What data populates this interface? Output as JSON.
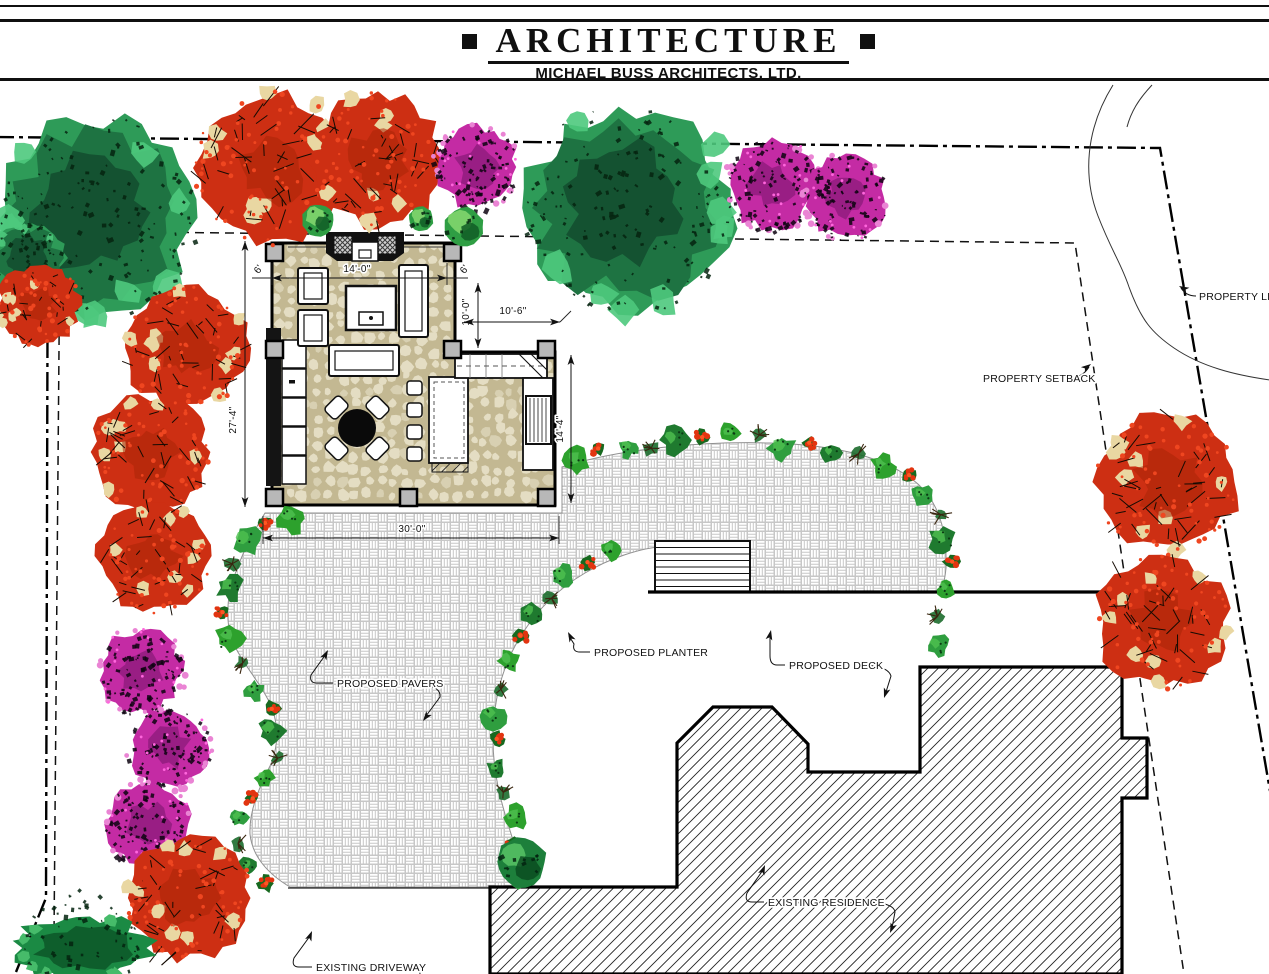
{
  "header": {
    "title": "ARCHITECTURE",
    "subtitle": "MICHAEL BUSS ARCHITECTS, LTD."
  },
  "plan": {
    "colors": {
      "paver_line": "#c7c7c7",
      "floor_bg": "#c3b892",
      "floor_stone": "#e4ddc3",
      "pier_fill": "#b8b8b8",
      "green_outer": "#2e9b58",
      "green_mid": "#1e7342",
      "green_core": "#145231",
      "green_light": "#4ec97d",
      "red_base": "#cd2f13",
      "red_dark": "#a92408",
      "red_dot": "#ef4620",
      "tan": "#e9d7a2",
      "magenta": "#c42ba4",
      "magenta_dark": "#7d1570",
      "magenta_light": "#ea84d4",
      "flower_red": "#e23410",
      "twig_brown": "#3a2610"
    },
    "boundary": {
      "property_line_path": "M-5,137 L1160,148 L1270,791 M48,141 L46,898 L16,972",
      "setback_path": "M60,231 L1075,243 L1184,974 M60,231 L54,935 L40,974",
      "walk_curve": "M1113,85 C1085,130 1083,177 1098,216 C1112,252 1121,263 1129,287 C1141,320 1152,333 1174,348 C1202,367 1235,375 1270,380",
      "walk_curve2": "M1152,85 C1138,100 1131,112 1127,127"
    },
    "annotations": [
      {
        "id": "property-line",
        "text": "PROPERTY LINE",
        "tx": 1199,
        "ty": 300,
        "leader": "M1196,296 Q1186,296 1181,288",
        "arrow": [
          1179,
          286,
          -152
        ]
      },
      {
        "id": "property-setback",
        "text": "PROPERTY SETBACK",
        "tx": 983,
        "ty": 382,
        "leader": "M1070,378 Q1083,377 1089,367",
        "arrow": [
          1091,
          364,
          -36
        ]
      },
      {
        "id": "proposed-planter",
        "text": "PROPOSED PLANTER",
        "tx": 594,
        "ty": 656,
        "leader": "M590,652 L580,652 Q572,652 574,644 L569,636",
        "arrow": [
          568,
          632,
          -117
        ]
      },
      {
        "id": "proposed-deck",
        "text": "PROPOSED DECK",
        "tx": 789,
        "ty": 669,
        "leader": "M785,665 L777,665 Q770,665 770,656 L770,635",
        "arrow": [
          771,
          630,
          -78
        ],
        "leader2": "M864,665 Q888,666 891,676 L886,692",
        "arrow2": [
          884,
          698,
          108
        ]
      },
      {
        "id": "proposed-pavers",
        "text": "PROPOSED PAVERS",
        "tx": 337,
        "ty": 687,
        "leader": "M333,683 L317,683 Q309,683 311,675 L326,654",
        "arrow": [
          328,
          650,
          -62
        ],
        "leader2": "M424,685 Q441,687 440,697 L426,716",
        "arrow2": [
          423,
          721,
          127
        ]
      },
      {
        "id": "existing-residence",
        "text": "EXISTING RESIDENCE",
        "tx": 768,
        "ty": 906,
        "leader": "M764,902 L752,902 Q744,902 747,893 L763,870",
        "arrow": [
          765,
          865,
          -68
        ],
        "leader2": "M868,902 Q894,903 895,912 L892,928",
        "arrow2": [
          890,
          933,
          112
        ]
      },
      {
        "id": "existing-driveway",
        "text": "EXISTING DRIVEWAY",
        "tx": 316,
        "ty": 971,
        "leader": "M312,967 L299,967 Q291,967 294,958 L310,936",
        "arrow": [
          312,
          931,
          -68
        ],
        "leader2": "M412,969 Q420,970 420,974"
      }
    ],
    "dimensions": [
      {
        "id": "dim-14-0",
        "text": "14'-0\"",
        "lx": 357,
        "ly": 272,
        "rot": 0,
        "line": [
          272,
          278,
          447,
          278
        ],
        "tails": [
          [
            252,
            278,
            272,
            278
          ],
          [
            447,
            278,
            468,
            278
          ]
        ],
        "ext": [
          [
            272,
            263,
            272,
            285
          ],
          [
            447,
            263,
            447,
            285
          ]
        ]
      },
      {
        "id": "dim-6-left",
        "text": "6'",
        "lx": 261,
        "ly": 271,
        "rot": -55
      },
      {
        "id": "dim-6-right",
        "text": "6'",
        "lx": 467,
        "ly": 271,
        "rot": -55
      },
      {
        "id": "dim-10-0",
        "text": "10'-0\"",
        "lx": 469,
        "ly": 312,
        "rot": -90,
        "line": [
          478,
          283,
          478,
          348
        ]
      },
      {
        "id": "dim-10-6",
        "text": "10'-6\"",
        "lx": 513,
        "ly": 314,
        "rot": 0,
        "line": [
          464,
          322,
          560,
          322
        ],
        "tails": [
          [
            560,
            322,
            571,
            311
          ]
        ]
      },
      {
        "id": "dim-14-4",
        "text": "14'-4\"",
        "lx": 563,
        "ly": 429,
        "rot": -90,
        "line": [
          571,
          355,
          571,
          503
        ]
      },
      {
        "id": "dim-27-4",
        "text": "27'-4\"",
        "lx": 236,
        "ly": 420,
        "rot": -90,
        "line": [
          245,
          241,
          245,
          507
        ]
      },
      {
        "id": "dim-30-0",
        "text": "30'-0\"",
        "lx": 412,
        "ly": 532,
        "rot": 0,
        "line": [
          263,
          538,
          559,
          538
        ],
        "ext": [
          [
            263,
            516,
            263,
            544
          ],
          [
            559,
            516,
            559,
            544
          ]
        ]
      }
    ],
    "trees": [
      {
        "type": "green",
        "cx": 95,
        "cy": 218,
        "r": 110,
        "seed": 1
      },
      {
        "type": "green",
        "cx": 628,
        "cy": 208,
        "r": 112,
        "seed": 2
      },
      {
        "type": "red",
        "cx": 272,
        "cy": 168,
        "r": 82,
        "seed": 3
      },
      {
        "type": "red",
        "cx": 378,
        "cy": 160,
        "r": 72,
        "seed": 4
      },
      {
        "type": "magenta",
        "cx": 477,
        "cy": 167,
        "r": 45,
        "seed": 5
      },
      {
        "type": "magenta",
        "cx": 772,
        "cy": 185,
        "r": 49,
        "seed": 6
      },
      {
        "type": "magenta",
        "cx": 846,
        "cy": 197,
        "r": 45,
        "seed": 7
      },
      {
        "type": "ball",
        "cx": 318,
        "cy": 220,
        "r": 17,
        "seed": 8
      },
      {
        "type": "ball",
        "cx": 421,
        "cy": 219,
        "r": 13,
        "seed": 9
      },
      {
        "type": "ball",
        "cx": 464,
        "cy": 227,
        "r": 21,
        "seed": 10
      },
      {
        "type": "green",
        "cx": 28,
        "cy": 258,
        "r": 40,
        "seed": 11
      },
      {
        "type": "red",
        "cx": 38,
        "cy": 305,
        "r": 45,
        "seed": 12
      },
      {
        "type": "red",
        "cx": 186,
        "cy": 348,
        "r": 67,
        "seed": 13
      },
      {
        "type": "red",
        "cx": 150,
        "cy": 452,
        "r": 63,
        "seed": 14
      },
      {
        "type": "red",
        "cx": 154,
        "cy": 556,
        "r": 61,
        "seed": 15
      },
      {
        "type": "magenta",
        "cx": 141,
        "cy": 671,
        "r": 46,
        "seed": 16
      },
      {
        "type": "magenta",
        "cx": 169,
        "cy": 748,
        "r": 44,
        "seed": 17
      },
      {
        "type": "magenta",
        "cx": 148,
        "cy": 824,
        "r": 45,
        "seed": 18
      },
      {
        "type": "red",
        "cx": 190,
        "cy": 898,
        "r": 68,
        "seed": 19
      },
      {
        "type": "hedge",
        "cx": 83,
        "cy": 948,
        "r": 78,
        "seed": 20
      },
      {
        "type": "red",
        "cx": 1168,
        "cy": 482,
        "r": 77,
        "seed": 21
      },
      {
        "type": "red",
        "cx": 1162,
        "cy": 622,
        "r": 72,
        "seed": 22
      },
      {
        "type": "ball-dark",
        "cx": 521,
        "cy": 862,
        "r": 27,
        "seed": 23
      }
    ],
    "beds": [
      {
        "id": "bed-upper",
        "seed": 31,
        "points": [
          [
            577,
            461
          ],
          [
            612,
            450
          ],
          [
            652,
            443
          ],
          [
            700,
            439
          ],
          [
            748,
            440
          ],
          [
            796,
            444
          ],
          [
            842,
            452
          ],
          [
            884,
            464
          ],
          [
            916,
            484
          ],
          [
            938,
            512
          ],
          [
            948,
            545
          ],
          [
            950,
            580
          ],
          [
            944,
            615
          ],
          [
            934,
            648
          ]
        ]
      },
      {
        "id": "bed-left",
        "seed": 32,
        "points": [
          [
            289,
            514
          ],
          [
            263,
            529
          ],
          [
            241,
            550
          ],
          [
            227,
            574
          ],
          [
            221,
            601
          ],
          [
            223,
            629
          ],
          [
            234,
            656
          ],
          [
            253,
            679
          ],
          [
            268,
            701
          ],
          [
            275,
            727
          ],
          [
            273,
            755
          ],
          [
            263,
            781
          ],
          [
            249,
            807
          ],
          [
            239,
            834
          ],
          [
            243,
            861
          ],
          [
            259,
            879
          ],
          [
            283,
            890
          ]
        ]
      },
      {
        "id": "bed-planter",
        "seed": 33,
        "points": [
          [
            612,
            552
          ],
          [
            584,
            566
          ],
          [
            558,
            585
          ],
          [
            536,
            610
          ],
          [
            518,
            640
          ],
          [
            506,
            672
          ],
          [
            499,
            706
          ],
          [
            497,
            740
          ],
          [
            502,
            774
          ],
          [
            511,
            806
          ],
          [
            517,
            838
          ],
          [
            518,
            866
          ],
          [
            514,
            884
          ]
        ]
      }
    ]
  }
}
